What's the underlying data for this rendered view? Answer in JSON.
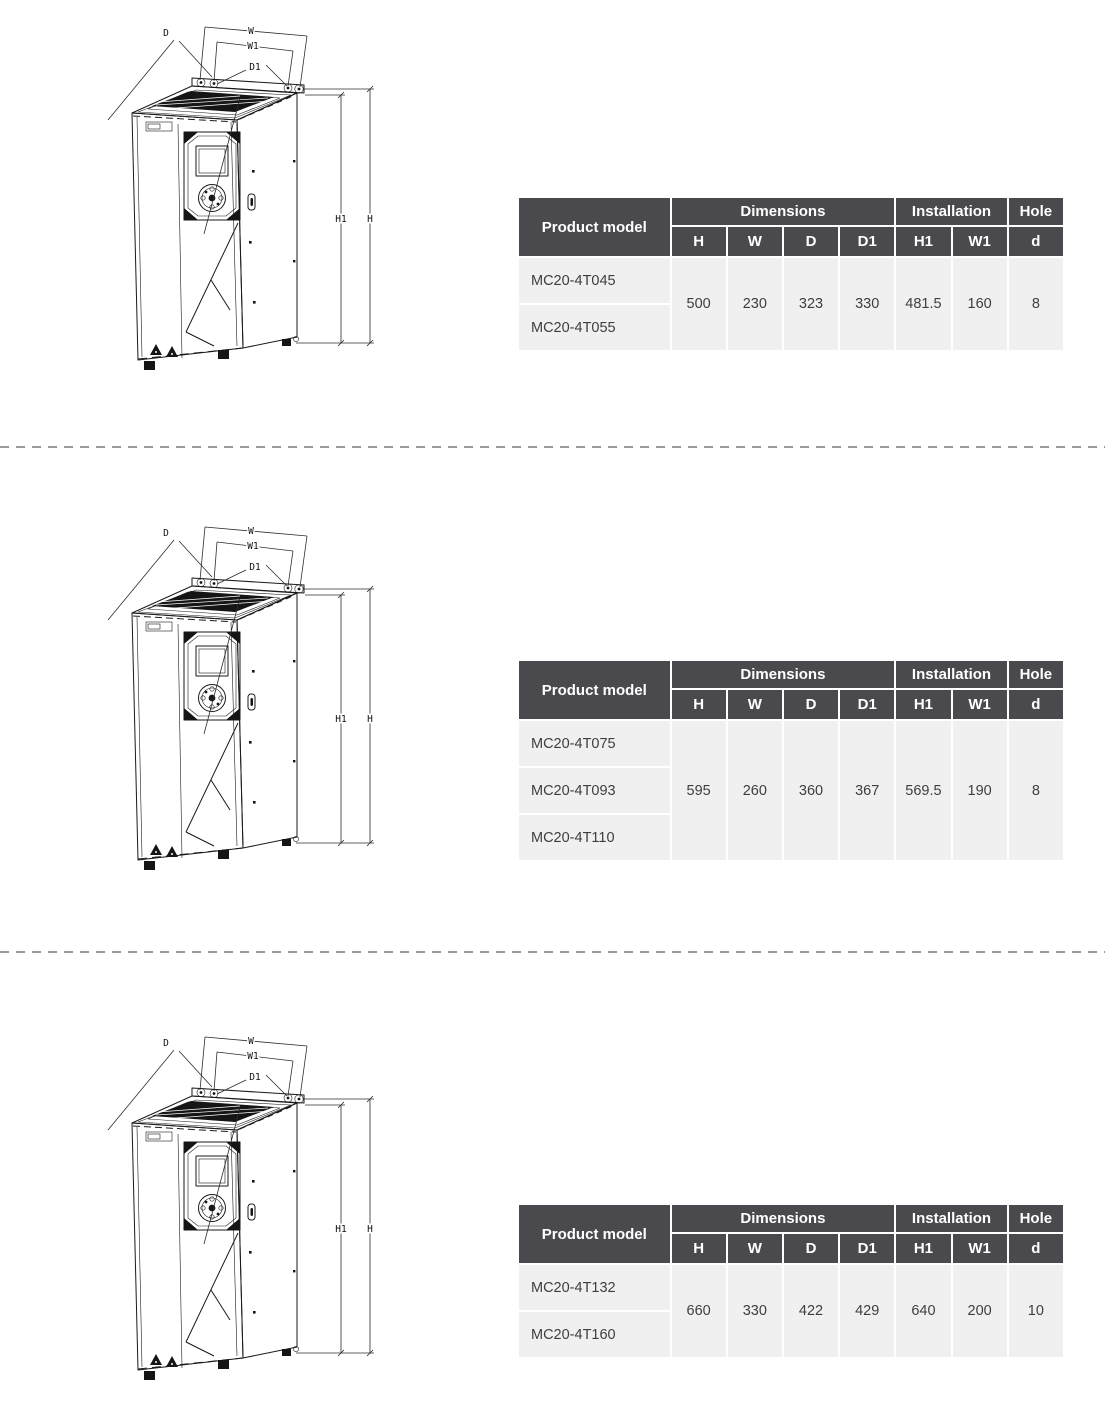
{
  "drawing": {
    "labels": {
      "d": "D",
      "w": "W",
      "w1": "W1",
      "d1": "D1",
      "h1": "H1",
      "h": "H"
    }
  },
  "table_headers": {
    "product_model": "Product model",
    "dimensions": "Dimensions",
    "installation": "Installation",
    "hole": "Hole",
    "h": "H",
    "w": "W",
    "d": "D",
    "d1": "D1",
    "h1": "H1",
    "w1": "W1",
    "d_hole": "d"
  },
  "tables": [
    {
      "models": [
        "MC20-4T045",
        "MC20-4T055"
      ],
      "values": {
        "h": "500",
        "w": "230",
        "d": "323",
        "d1": "330",
        "h1": "481.5",
        "w1": "160",
        "d_hole": "8"
      }
    },
    {
      "models": [
        "MC20-4T075",
        "MC20-4T093",
        "MC20-4T110"
      ],
      "values": {
        "h": "595",
        "w": "260",
        "d": "360",
        "d1": "367",
        "h1": "569.5",
        "w1": "190",
        "d_hole": "8"
      }
    },
    {
      "models": [
        "MC20-4T132",
        "MC20-4T160"
      ],
      "values": {
        "h": "660",
        "w": "330",
        "d": "422",
        "d1": "429",
        "h1": "640",
        "w1": "200",
        "d_hole": "10"
      }
    }
  ],
  "colors": {
    "table_header_bg": "#4a4a4e",
    "table_row_bg": "#f0f0f0",
    "line_color": "#1a1a1a",
    "dash_color": "#9a9a9a"
  }
}
